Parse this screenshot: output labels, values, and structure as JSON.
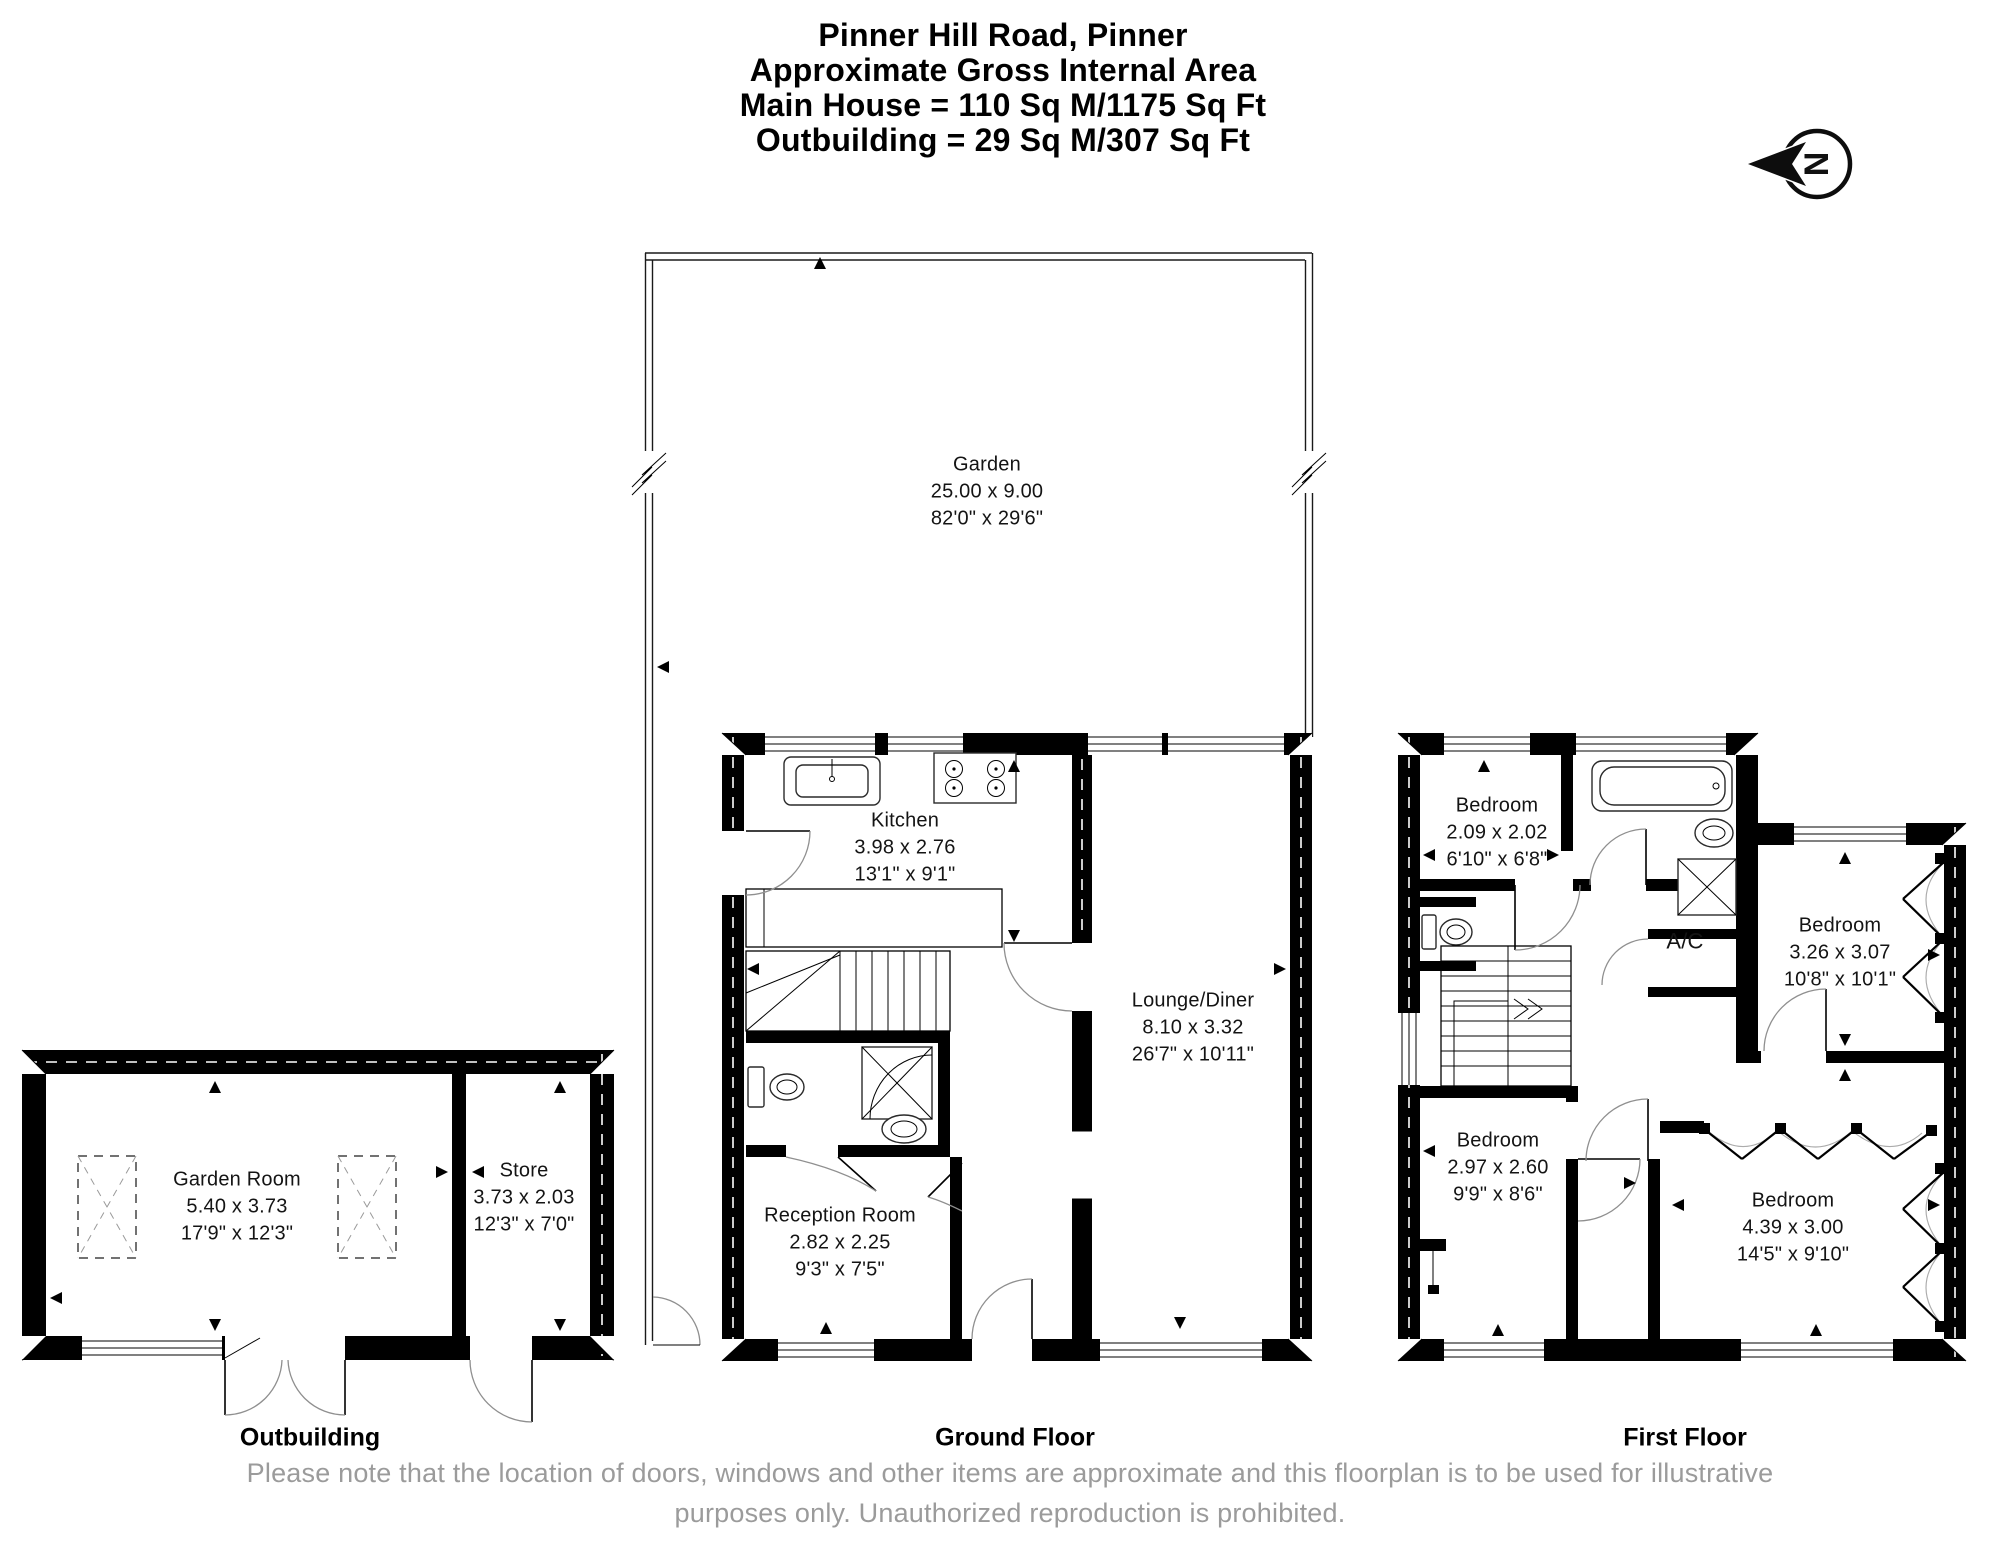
{
  "title": {
    "line1": "Pinner Hill Road, Pinner",
    "line2": "Approximate Gross Internal Area",
    "line3": "Main House = 110 Sq M/1175 Sq Ft",
    "line4": "Outbuilding = 29 Sq M/307 Sq Ft"
  },
  "compass": {
    "letter": "N"
  },
  "rooms": {
    "garden": {
      "name": "Garden",
      "metric": "25.00 x 9.00",
      "imperial": "82'0\" x 29'6\""
    },
    "kitchen": {
      "name": "Kitchen",
      "metric": "3.98 x 2.76",
      "imperial": "13'1\" x 9'1\""
    },
    "lounge_diner": {
      "name": "Lounge/Diner",
      "metric": "8.10 x 3.32",
      "imperial": "26'7\" x 10'11\""
    },
    "reception": {
      "name": "Reception Room",
      "metric": "2.82 x 2.25",
      "imperial": "9'3\" x 7'5\""
    },
    "garden_room": {
      "name": "Garden Room",
      "metric": "5.40 x 3.73",
      "imperial": "17'9\" x 12'3\""
    },
    "store": {
      "name": "Store",
      "metric": "3.73 x 2.03",
      "imperial": "12'3\" x 7'0\""
    },
    "bedroom_1": {
      "name": "Bedroom",
      "metric": "2.09 x 2.02",
      "imperial": "6'10\" x 6'8\""
    },
    "bedroom_2": {
      "name": "Bedroom",
      "metric": "3.26 x 3.07",
      "imperial": "10'8\" x 10'1\""
    },
    "bedroom_3": {
      "name": "Bedroom",
      "metric": "2.97 x 2.60",
      "imperial": "9'9\" x 8'6\""
    },
    "bedroom_4": {
      "name": "Bedroom",
      "metric": "4.39 x 3.00",
      "imperial": "14'5\" x 9'10\""
    },
    "ac": {
      "name": "A/C"
    }
  },
  "floors": {
    "outbuilding": "Outbuilding",
    "ground": "Ground Floor",
    "first": "First Floor"
  },
  "footer": {
    "line1": "Please note that the location of doors, windows and other items are approximate and this floorplan is to be used for illustrative",
    "line2": "purposes only. Unauthorized reproduction is prohibited."
  },
  "colors": {
    "wall": "#000000",
    "footer_text": "#9b9b9b",
    "door_arc": "#8f8f8f"
  }
}
